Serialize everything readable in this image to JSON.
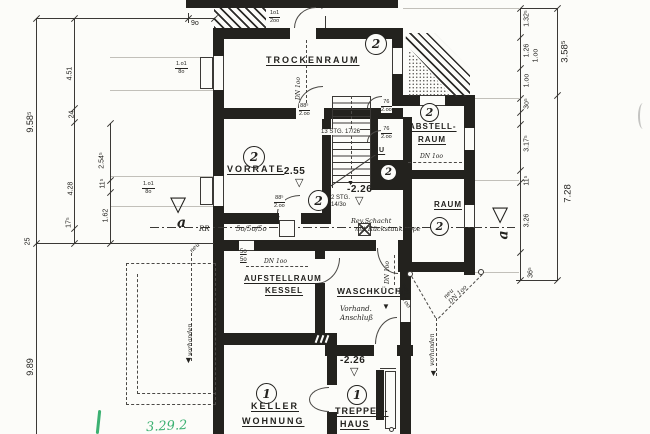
{
  "drawing": {
    "rooms": {
      "trockenraum": {
        "num": "2",
        "name": "TROCKENRAUM"
      },
      "vorrate": {
        "num": "2",
        "name": "VORRATE"
      },
      "abstellraum": {
        "num": "2",
        "name1": "ABSTELL-",
        "name2": "RAUM"
      },
      "raum": {
        "num": "2",
        "name": "RAUM"
      },
      "du": {
        "num": "2",
        "name": "DU"
      },
      "flur": {
        "num": "2"
      },
      "aufstellraum": {
        "name1": "AUFSTELLRAUM",
        "name2": "KESSEL"
      },
      "waschkueche": {
        "name": "WASCHKÜCHE"
      },
      "kellerwohnung": {
        "num": "1",
        "name1": "KELLER",
        "name2": "WOHNUNG"
      },
      "treppenhaus": {
        "num": "1",
        "name1": "TREPPEN-",
        "name2": "HAUS"
      }
    },
    "levels": {
      "minus255": "-2.55",
      "minus226": "-2.26"
    },
    "stairs": {
      "flight13": "13 STG. 17/26",
      "flight2a": "2 STG.",
      "flight2b": "14/3o"
    },
    "openings": {
      "d101_t": "1o1",
      "d101_b": "2oo",
      "d885_t": "88⁵",
      "d885_b": "2.oo",
      "d76_t": "76",
      "d76_b": "2.oo",
      "w101_t": "1.o1",
      "w101_b": "8o"
    },
    "pipes": {
      "dn100": "DN 1oo",
      "neu": "neu",
      "vorhanden": "vorhanden",
      "rr": "RR"
    },
    "annotations": {
      "pumpensumpf": "Pumpensumpf",
      "pumpensumpf_size": "5o/5o/5o",
      "revschacht1": "Rev.Schacht",
      "revschacht2": "mit Rückstauklappe",
      "vorhand1": "Vorhand.",
      "vorhand2": "Anschluß",
      "section_letter": "a"
    },
    "dimensions": {
      "left": {
        "outer_top": "9.58⁵",
        "outer_bottom": "9.89",
        "seg_25": "25",
        "seg_451": "4.51",
        "seg_24": "24",
        "seg_428": "4.28",
        "seg_175": "17⁵",
        "seg_2545": "2.54⁵",
        "seg_115": "11⁵",
        "seg_162": "1.62",
        "seg_90": "9o"
      },
      "right": {
        "outer_top": "3.58⁵",
        "outer_bottom": "7.28",
        "seg_1325": "1.32⁵",
        "seg_126": "1.26",
        "seg_100": "1.oo",
        "seg_305": "3o⁵",
        "seg_3175": "3.17⁵",
        "seg_115": "11⁵",
        "seg_326": "3.26",
        "seg_365": "36⁵"
      },
      "seg_50": "5o"
    },
    "symbols": {
      "tri_open": "▽",
      "tri_filled": "▼"
    },
    "handwriting": "3.29.2"
  }
}
